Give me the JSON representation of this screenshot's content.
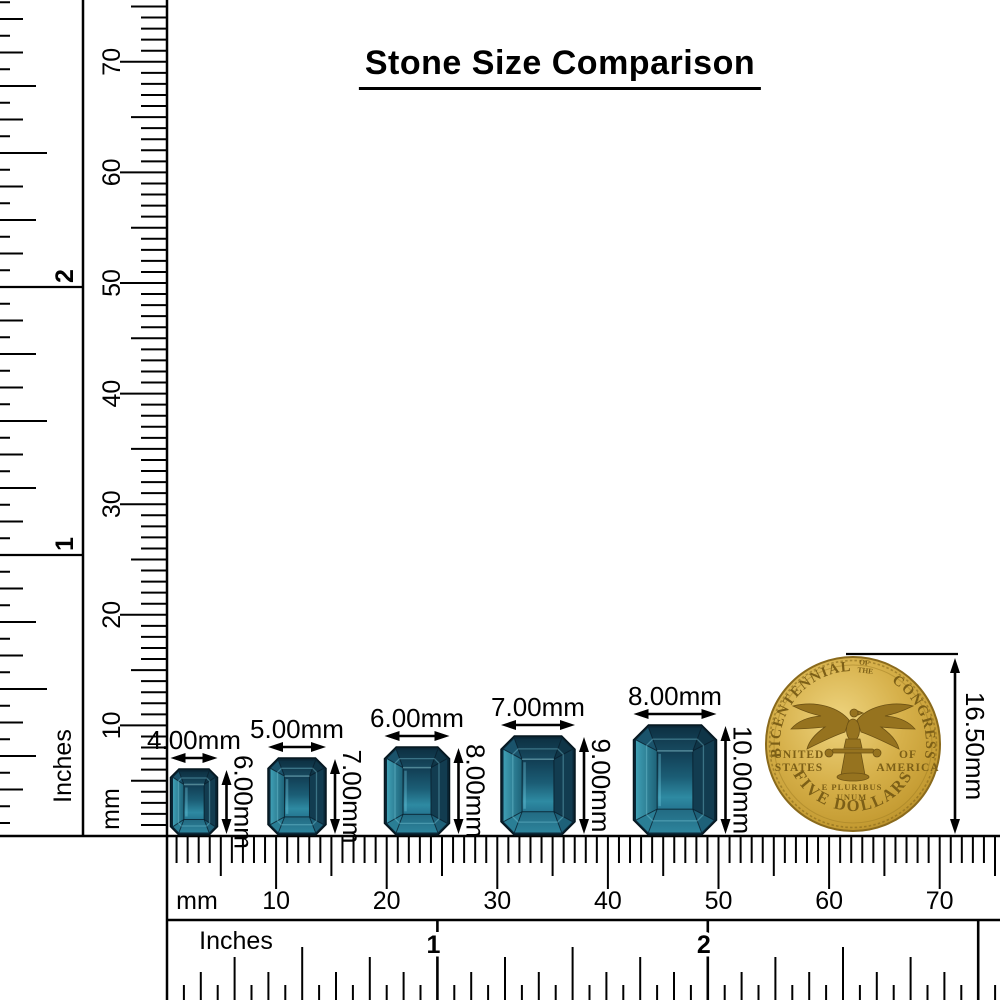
{
  "title": "Stone Size Comparison",
  "rulers": {
    "left_inches": {
      "title": "Inches",
      "labels": [
        "1",
        "2"
      ]
    },
    "left_mm": {
      "title": "mm",
      "labels": [
        "10",
        "20",
        "30",
        "40",
        "50",
        "60",
        "70"
      ]
    },
    "bottom_mm": {
      "title": "mm",
      "labels": [
        "10",
        "20",
        "30",
        "40",
        "50",
        "60",
        "70"
      ]
    },
    "bottom_inches": {
      "title": "Inches",
      "labels": [
        "1",
        "2"
      ]
    }
  },
  "stones": [
    {
      "name": "stone-4x6mm",
      "width_label": "4.00mm",
      "height_label": "6.00mm",
      "width_mm": 4,
      "height_mm": 6
    },
    {
      "name": "stone-5x7mm",
      "width_label": "5.00mm",
      "height_label": "7.00mm",
      "width_mm": 5,
      "height_mm": 7
    },
    {
      "name": "stone-6x8mm",
      "width_label": "6.00mm",
      "height_label": "8.00mm",
      "width_mm": 6,
      "height_mm": 8
    },
    {
      "name": "stone-7x9mm",
      "width_label": "7.00mm",
      "height_label": "9.00mm",
      "width_mm": 7,
      "height_mm": 9
    },
    {
      "name": "stone-8x10mm",
      "width_label": "8.00mm",
      "height_label": "10.00mm",
      "width_mm": 8,
      "height_mm": 10
    }
  ],
  "coin": {
    "name": "five-dollar-bicentennial-coin",
    "legend_arc_left": "BICENTENNIAL",
    "legend_arc_small_1": "OF",
    "legend_arc_small_2": "THE",
    "legend_arc_right": "CONGRESS",
    "left_line1": "UNITED",
    "left_line2": "STATES",
    "right_line1": "OF",
    "right_line2": "AMERICA",
    "motto_line1": "E PLURIBUS",
    "motto_line2": "UNUM",
    "bottom_legend": "FIVE DOLLARS",
    "diameter_label": "16.50mm"
  },
  "colors": {
    "line": "#000000",
    "background": "#ffffff",
    "stone_dark": "#0c2d3d",
    "stone_teal": "#2e8ba3",
    "coin_gold": "#cda43c"
  }
}
